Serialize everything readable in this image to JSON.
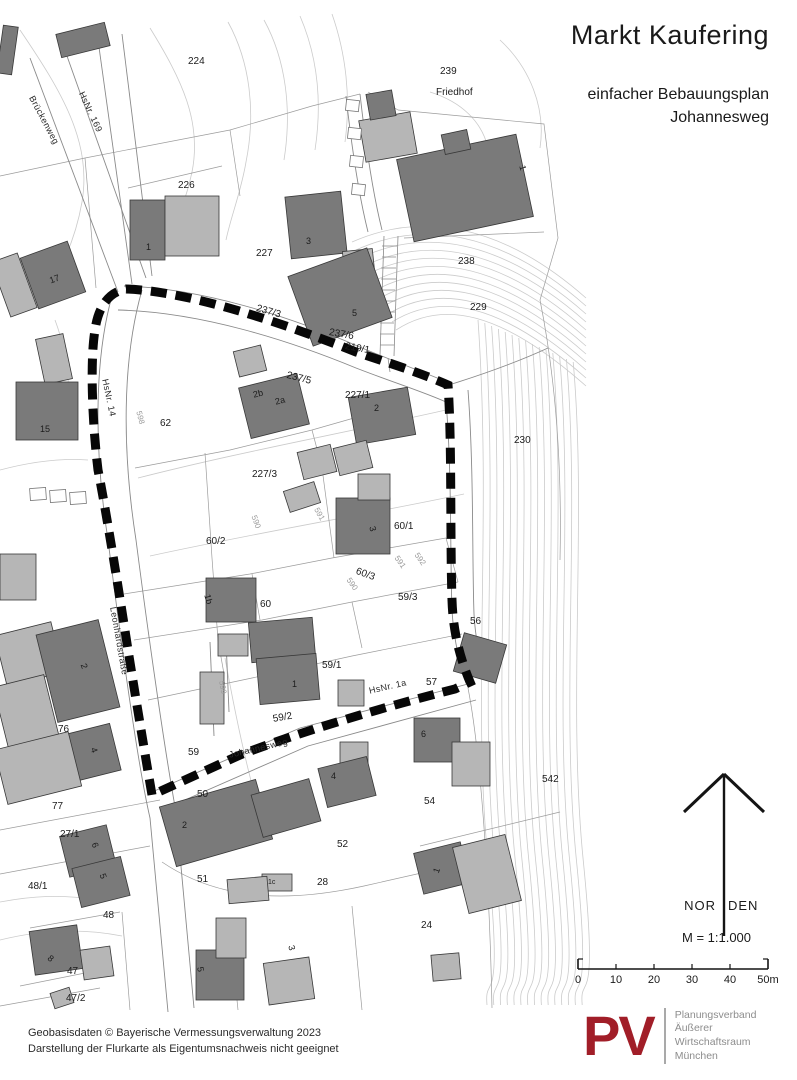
{
  "title": {
    "main": "Markt Kaufering",
    "sub1": "einfacher Bebauungsplan",
    "sub2": "Johannesweg"
  },
  "legend": {
    "north_left": "NOR",
    "north_right": "DEN",
    "scale_label": "M = 1:1.000",
    "scale_ticks": [
      "0",
      "10",
      "20",
      "30",
      "40",
      "50m"
    ]
  },
  "footer": {
    "line1": "Geobasisdaten © Bayerische Vermessungsverwaltung 2023",
    "line2": "Darstellung der Flurkarte als Eigentumsnachweis nicht geeignet"
  },
  "logo": {
    "abbrev": "PV",
    "color": "#a11e28",
    "name_lines": [
      "Planungsverband",
      "Äußerer",
      "Wirtschaftsraum",
      "München"
    ]
  },
  "map": {
    "colors": {
      "building_dark": "#7a7a7a",
      "building_light": "#b6b6b6",
      "shed_white": "#ffffff",
      "building_stroke": "#383838"
    },
    "buildings": [
      {
        "x": 58,
        "y": 28,
        "w": 50,
        "h": 24,
        "r": -14,
        "t": "d"
      },
      {
        "x": 0,
        "y": 26,
        "w": 15,
        "h": 48,
        "r": 8,
        "t": "d"
      },
      {
        "x": 28,
        "y": 248,
        "w": 50,
        "h": 54,
        "r": -20,
        "t": "d"
      },
      {
        "x": 0,
        "y": 256,
        "w": 28,
        "h": 58,
        "r": -20,
        "t": "l"
      },
      {
        "x": 40,
        "y": 336,
        "w": 28,
        "h": 46,
        "r": -12,
        "t": "l"
      },
      {
        "x": 16,
        "y": 382,
        "w": 62,
        "h": 58,
        "r": 0,
        "t": "d"
      },
      {
        "x": 130,
        "y": 200,
        "w": 35,
        "h": 60,
        "r": 0,
        "t": "d"
      },
      {
        "x": 165,
        "y": 196,
        "w": 54,
        "h": 60,
        "r": 0,
        "t": "l"
      },
      {
        "x": 288,
        "y": 194,
        "w": 56,
        "h": 62,
        "r": -6,
        "t": "d"
      },
      {
        "x": 344,
        "y": 250,
        "w": 30,
        "h": 32,
        "r": -6,
        "t": "l"
      },
      {
        "x": 298,
        "y": 260,
        "w": 84,
        "h": 74,
        "r": -20,
        "t": "d"
      },
      {
        "x": 404,
        "y": 146,
        "w": 122,
        "h": 84,
        "r": -12,
        "t": "d"
      },
      {
        "x": 443,
        "y": 132,
        "w": 26,
        "h": 20,
        "r": -12,
        "t": "d"
      },
      {
        "x": 362,
        "y": 116,
        "w": 52,
        "h": 42,
        "r": -10,
        "t": "l"
      },
      {
        "x": 368,
        "y": 92,
        "w": 26,
        "h": 26,
        "r": -10,
        "t": "d"
      },
      {
        "x": 236,
        "y": 348,
        "w": 28,
        "h": 26,
        "r": -14,
        "t": "l"
      },
      {
        "x": 244,
        "y": 380,
        "w": 60,
        "h": 52,
        "r": -14,
        "t": "d"
      },
      {
        "x": 352,
        "y": 392,
        "w": 60,
        "h": 48,
        "r": -10,
        "t": "d"
      },
      {
        "x": 300,
        "y": 448,
        "w": 34,
        "h": 28,
        "r": -14,
        "t": "l"
      },
      {
        "x": 336,
        "y": 444,
        "w": 34,
        "h": 28,
        "r": -14,
        "t": "l"
      },
      {
        "x": 286,
        "y": 486,
        "w": 32,
        "h": 22,
        "r": -18,
        "t": "l"
      },
      {
        "x": 336,
        "y": 498,
        "w": 54,
        "h": 56,
        "r": 0,
        "t": "d"
      },
      {
        "x": 358,
        "y": 474,
        "w": 32,
        "h": 26,
        "r": 0,
        "t": "l"
      },
      {
        "x": 206,
        "y": 578,
        "w": 50,
        "h": 44,
        "r": 0,
        "t": "d"
      },
      {
        "x": 218,
        "y": 634,
        "w": 30,
        "h": 22,
        "r": 0,
        "t": "l"
      },
      {
        "x": 250,
        "y": 620,
        "w": 64,
        "h": 40,
        "r": -5,
        "t": "d"
      },
      {
        "x": 258,
        "y": 656,
        "w": 60,
        "h": 46,
        "r": -5,
        "t": "d"
      },
      {
        "x": 200,
        "y": 672,
        "w": 24,
        "h": 52,
        "r": 0,
        "t": "l"
      },
      {
        "x": 338,
        "y": 680,
        "w": 26,
        "h": 26,
        "r": 0,
        "t": "l"
      },
      {
        "x": 414,
        "y": 718,
        "w": 46,
        "h": 44,
        "r": 0,
        "t": "d"
      },
      {
        "x": 452,
        "y": 742,
        "w": 38,
        "h": 44,
        "r": 0,
        "t": "l"
      },
      {
        "x": 340,
        "y": 742,
        "w": 28,
        "h": 24,
        "r": 0,
        "t": "l"
      },
      {
        "x": 322,
        "y": 762,
        "w": 50,
        "h": 40,
        "r": -14,
        "t": "d"
      },
      {
        "x": 166,
        "y": 792,
        "w": 100,
        "h": 62,
        "r": -16,
        "t": "d"
      },
      {
        "x": 256,
        "y": 786,
        "w": 60,
        "h": 44,
        "r": -16,
        "t": "d"
      },
      {
        "x": 458,
        "y": 638,
        "w": 44,
        "h": 40,
        "r": 16,
        "t": "d"
      },
      {
        "x": 418,
        "y": 847,
        "w": 48,
        "h": 42,
        "r": -14,
        "t": "d"
      },
      {
        "x": 460,
        "y": 840,
        "w": 54,
        "h": 68,
        "r": -14,
        "t": "l"
      },
      {
        "x": 432,
        "y": 954,
        "w": 28,
        "h": 26,
        "r": -5,
        "t": "l"
      },
      {
        "x": 196,
        "y": 950,
        "w": 48,
        "h": 50,
        "r": 0,
        "t": "d"
      },
      {
        "x": 216,
        "y": 918,
        "w": 30,
        "h": 40,
        "r": 0,
        "t": "l"
      },
      {
        "x": 266,
        "y": 960,
        "w": 46,
        "h": 42,
        "r": -8,
        "t": "l"
      },
      {
        "x": 262,
        "y": 874,
        "w": 30,
        "h": 17,
        "r": 0,
        "t": "l"
      },
      {
        "x": 228,
        "y": 878,
        "w": 40,
        "h": 24,
        "r": -5,
        "t": "l"
      },
      {
        "x": 64,
        "y": 830,
        "w": 48,
        "h": 42,
        "r": -14,
        "t": "d"
      },
      {
        "x": 76,
        "y": 862,
        "w": 50,
        "h": 40,
        "r": -14,
        "t": "d"
      },
      {
        "x": 32,
        "y": 928,
        "w": 48,
        "h": 44,
        "r": -8,
        "t": "d"
      },
      {
        "x": 82,
        "y": 948,
        "w": 30,
        "h": 30,
        "r": -8,
        "t": "l"
      },
      {
        "x": 0,
        "y": 628,
        "w": 58,
        "h": 52,
        "r": -14,
        "t": "l"
      },
      {
        "x": 46,
        "y": 626,
        "w": 64,
        "h": 90,
        "r": -14,
        "t": "d"
      },
      {
        "x": 0,
        "y": 680,
        "w": 52,
        "h": 62,
        "r": -14,
        "t": "l"
      },
      {
        "x": 72,
        "y": 728,
        "w": 44,
        "h": 48,
        "r": -14,
        "t": "d"
      },
      {
        "x": 0,
        "y": 740,
        "w": 76,
        "h": 56,
        "r": -14,
        "t": "l"
      },
      {
        "x": 0,
        "y": 554,
        "w": 36,
        "h": 46,
        "r": 0,
        "t": "l"
      },
      {
        "x": 52,
        "y": 990,
        "w": 20,
        "h": 16,
        "r": -18,
        "t": "l"
      },
      {
        "x": 30,
        "y": 488,
        "w": 16,
        "h": 12,
        "r": -4,
        "t": "w"
      },
      {
        "x": 50,
        "y": 490,
        "w": 16,
        "h": 12,
        "r": -4,
        "t": "w"
      },
      {
        "x": 70,
        "y": 492,
        "w": 16,
        "h": 12,
        "r": -4,
        "t": "w"
      },
      {
        "x": 346,
        "y": 100,
        "w": 13,
        "h": 11,
        "r": 6,
        "t": "w"
      },
      {
        "x": 348,
        "y": 128,
        "w": 13,
        "h": 11,
        "r": 6,
        "t": "w"
      },
      {
        "x": 350,
        "y": 156,
        "w": 13,
        "h": 11,
        "r": 6,
        "t": "w"
      },
      {
        "x": 352,
        "y": 184,
        "w": 13,
        "h": 11,
        "r": 6,
        "t": "w"
      }
    ],
    "labels": {
      "parcels": [
        {
          "t": "224",
          "x": 188,
          "y": 56
        },
        {
          "t": "239",
          "x": 440,
          "y": 66
        },
        {
          "t": "Friedhof",
          "x": 436,
          "y": 87
        },
        {
          "t": "226",
          "x": 178,
          "y": 180
        },
        {
          "t": "227",
          "x": 256,
          "y": 248
        },
        {
          "t": "238",
          "x": 458,
          "y": 256
        },
        {
          "t": "229",
          "x": 470,
          "y": 302
        },
        {
          "t": "230",
          "x": 514,
          "y": 435
        },
        {
          "t": "237/3",
          "x": 258,
          "y": 303,
          "r": 16
        },
        {
          "t": "237/6",
          "x": 330,
          "y": 327,
          "r": 10
        },
        {
          "t": "219/1",
          "x": 346,
          "y": 341,
          "r": 10
        },
        {
          "t": "237/5",
          "x": 288,
          "y": 370,
          "r": 14
        },
        {
          "t": "227/1",
          "x": 345,
          "y": 390
        },
        {
          "t": "62",
          "x": 160,
          "y": 418
        },
        {
          "t": "227/3",
          "x": 252,
          "y": 469
        },
        {
          "t": "60/2",
          "x": 206,
          "y": 536
        },
        {
          "t": "60/1",
          "x": 394,
          "y": 521
        },
        {
          "t": "60/3",
          "x": 358,
          "y": 566,
          "r": 20
        },
        {
          "t": "59/3",
          "x": 398,
          "y": 592
        },
        {
          "t": "60",
          "x": 260,
          "y": 599
        },
        {
          "t": "56",
          "x": 470,
          "y": 616
        },
        {
          "t": "59/1",
          "x": 322,
          "y": 660
        },
        {
          "t": "57",
          "x": 426,
          "y": 677
        },
        {
          "t": "59/2",
          "x": 272,
          "y": 714,
          "r": -10
        },
        {
          "t": "59",
          "x": 188,
          "y": 747
        },
        {
          "t": "76",
          "x": 58,
          "y": 724
        },
        {
          "t": "77",
          "x": 52,
          "y": 801
        },
        {
          "t": "50",
          "x": 197,
          "y": 789
        },
        {
          "t": "54",
          "x": 424,
          "y": 796
        },
        {
          "t": "27/1",
          "x": 60,
          "y": 829
        },
        {
          "t": "52",
          "x": 337,
          "y": 839
        },
        {
          "t": "51",
          "x": 197,
          "y": 874
        },
        {
          "t": "28",
          "x": 317,
          "y": 877
        },
        {
          "t": "48/1",
          "x": 28,
          "y": 881
        },
        {
          "t": "48",
          "x": 103,
          "y": 910
        },
        {
          "t": "24",
          "x": 421,
          "y": 920
        },
        {
          "t": "47",
          "x": 67,
          "y": 966
        },
        {
          "t": "47/2",
          "x": 66,
          "y": 993
        },
        {
          "t": "542",
          "x": 542,
          "y": 774
        }
      ],
      "houses": [
        {
          "t": "1",
          "x": 146,
          "y": 242
        },
        {
          "t": "17",
          "x": 48,
          "y": 276,
          "r": -20
        },
        {
          "t": "15",
          "x": 40,
          "y": 424
        },
        {
          "t": "3",
          "x": 306,
          "y": 236
        },
        {
          "t": "5",
          "x": 352,
          "y": 308
        },
        {
          "t": "1",
          "x": 527,
          "y": 164,
          "r": 75
        },
        {
          "t": "2b",
          "x": 252,
          "y": 390,
          "r": -14
        },
        {
          "t": "2a",
          "x": 274,
          "y": 397,
          "r": -14
        },
        {
          "t": "2",
          "x": 374,
          "y": 403
        },
        {
          "t": "3",
          "x": 377,
          "y": 525,
          "r": 75
        },
        {
          "t": "1b",
          "x": 212,
          "y": 593,
          "r": 75
        },
        {
          "t": "1",
          "x": 292,
          "y": 679
        },
        {
          "t": "6",
          "x": 421,
          "y": 729
        },
        {
          "t": "4",
          "x": 331,
          "y": 771
        },
        {
          "t": "2",
          "x": 182,
          "y": 820
        },
        {
          "t": "1",
          "x": 431,
          "y": 871,
          "r": -70
        },
        {
          "t": "1c",
          "x": 268,
          "y": 879,
          "s": 7
        },
        {
          "t": "5",
          "x": 205,
          "y": 966,
          "r": 80
        },
        {
          "t": "3",
          "x": 296,
          "y": 944,
          "r": 75
        },
        {
          "t": "6",
          "x": 99,
          "y": 841,
          "r": 70
        },
        {
          "t": "5",
          "x": 107,
          "y": 872,
          "r": 70
        },
        {
          "t": "8",
          "x": 52,
          "y": 953,
          "r": 40
        },
        {
          "t": "2",
          "x": 88,
          "y": 662,
          "r": 70
        },
        {
          "t": "4",
          "x": 98,
          "y": 746,
          "r": 70
        }
      ],
      "streets": [
        {
          "t": "Brückenweg",
          "x": 36,
          "y": 94,
          "r": 62
        },
        {
          "t": "HsNr. 169",
          "x": 86,
          "y": 90,
          "r": 65
        },
        {
          "t": "HsNr. 14",
          "x": 110,
          "y": 378,
          "r": 78
        },
        {
          "t": "Leonhardstraße",
          "x": 118,
          "y": 606,
          "r": 80
        },
        {
          "t": "Johannesweg",
          "x": 228,
          "y": 750,
          "r": -13
        },
        {
          "t": "HsNr. 1a",
          "x": 368,
          "y": 686,
          "r": -13
        }
      ],
      "contours": [
        {
          "t": "598",
          "x": 143,
          "y": 410,
          "r": 75
        },
        {
          "t": "590",
          "x": 258,
          "y": 514,
          "r": 70
        },
        {
          "t": "591",
          "x": 320,
          "y": 506,
          "r": 60
        },
        {
          "t": "590",
          "x": 352,
          "y": 576,
          "r": 55
        },
        {
          "t": "591",
          "x": 400,
          "y": 554,
          "r": 55
        },
        {
          "t": "592",
          "x": 420,
          "y": 551,
          "r": 55
        },
        {
          "t": "599",
          "x": 226,
          "y": 680,
          "r": 80
        }
      ]
    }
  }
}
